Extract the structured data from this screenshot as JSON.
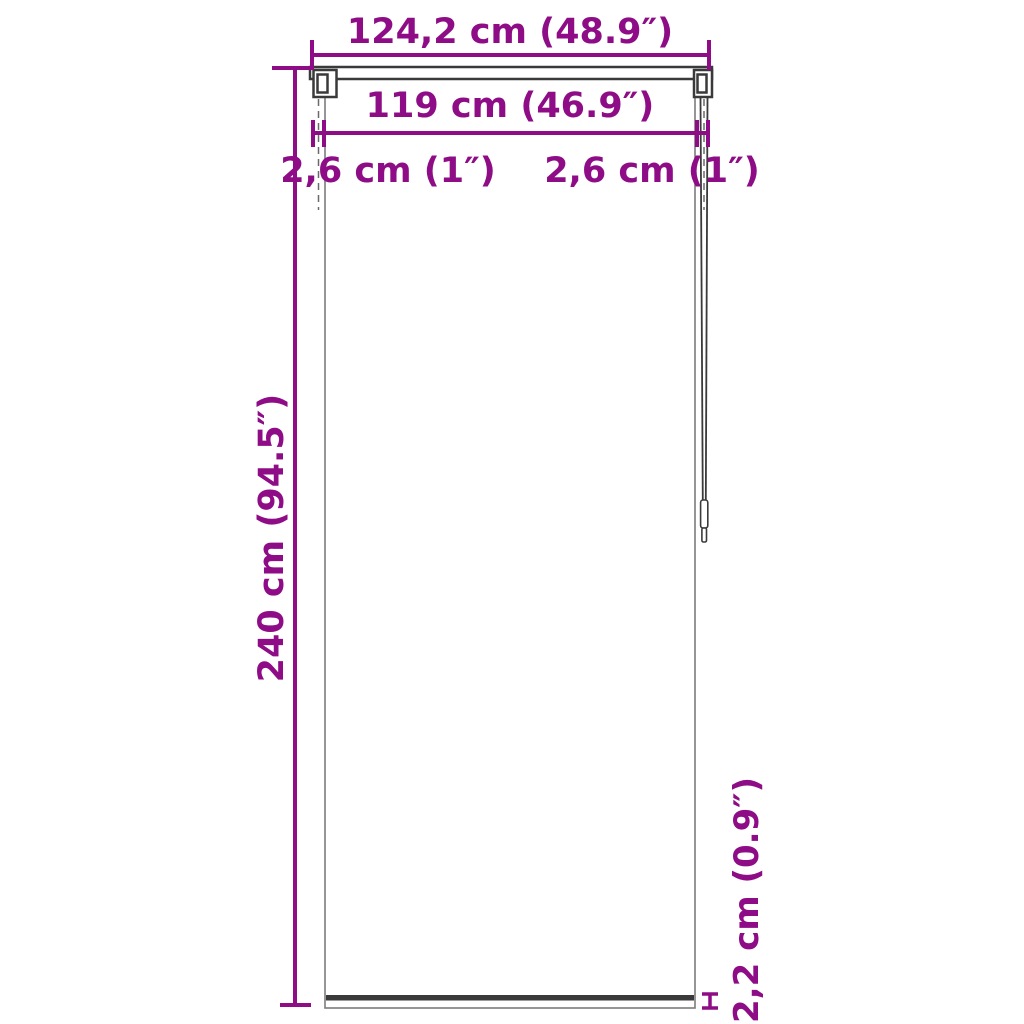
{
  "colors": {
    "dimension_accent": "#8E0D87",
    "blind_outline": "#3A3A3A",
    "panel_edge": "#7C7C7C"
  },
  "dimensions": {
    "total_width": "124,2 cm (48.9″)",
    "fabric_width": "119 cm (46.9″)",
    "left_bracket_offset": "2,6 cm (1″)",
    "right_bracket_offset": "2,6 cm (1″)",
    "height": "240 cm (94.5″)",
    "bottom_bar_height": "2,2 cm (0.9″)"
  }
}
